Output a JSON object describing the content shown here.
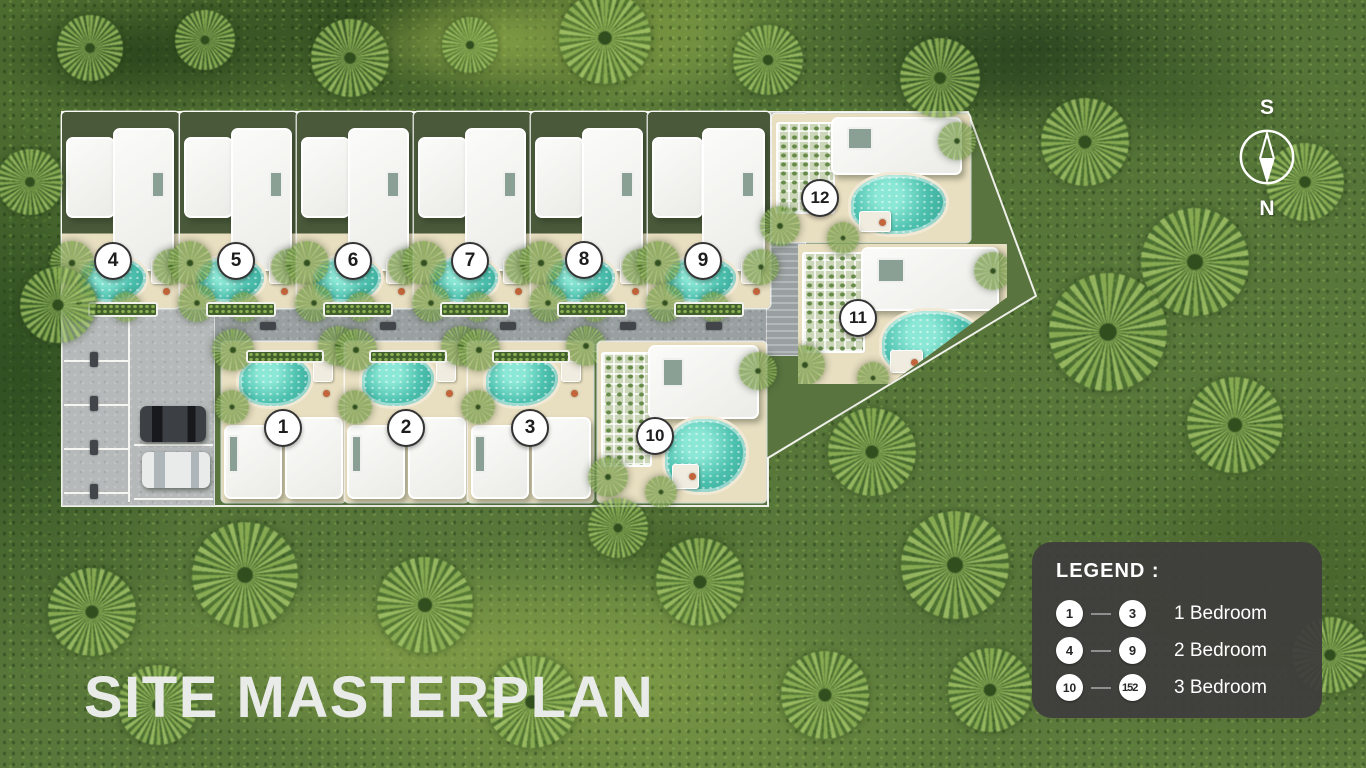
{
  "title": "SITE MASTERPLAN",
  "compass": {
    "top": "S",
    "bottom": "N"
  },
  "legend": {
    "heading": "LEGEND :",
    "rows": [
      {
        "from": "1",
        "to": "3",
        "label": "1 Bedroom"
      },
      {
        "from": "4",
        "to": "9",
        "label": "2 Bedroom"
      },
      {
        "from": "10",
        "to": "152",
        "label": "3 Bedroom"
      }
    ]
  },
  "units": [
    {
      "number": "1",
      "type": "bottom",
      "plot": {
        "x": 222,
        "y": 342,
        "w": 123,
        "h": 160
      },
      "badge": {
        "x": 283,
        "y": 428
      }
    },
    {
      "number": "2",
      "type": "bottom",
      "plot": {
        "x": 345,
        "y": 342,
        "w": 123,
        "h": 160
      },
      "badge": {
        "x": 406,
        "y": 428
      }
    },
    {
      "number": "3",
      "type": "bottom",
      "plot": {
        "x": 468,
        "y": 342,
        "w": 125,
        "h": 160
      },
      "badge": {
        "x": 530,
        "y": 428
      }
    },
    {
      "number": "4",
      "type": "top",
      "plot": {
        "x": 62,
        "y": 112,
        "w": 117,
        "h": 196
      },
      "badge": {
        "x": 113,
        "y": 261
      }
    },
    {
      "number": "5",
      "type": "top",
      "plot": {
        "x": 180,
        "y": 112,
        "w": 117,
        "h": 196
      },
      "badge": {
        "x": 236,
        "y": 261
      }
    },
    {
      "number": "6",
      "type": "top",
      "plot": {
        "x": 297,
        "y": 112,
        "w": 117,
        "h": 196
      },
      "badge": {
        "x": 353,
        "y": 261
      }
    },
    {
      "number": "7",
      "type": "top",
      "plot": {
        "x": 414,
        "y": 112,
        "w": 117,
        "h": 196
      },
      "badge": {
        "x": 470,
        "y": 261
      }
    },
    {
      "number": "8",
      "type": "top",
      "plot": {
        "x": 531,
        "y": 112,
        "w": 117,
        "h": 196
      },
      "badge": {
        "x": 584,
        "y": 260
      }
    },
    {
      "number": "9",
      "type": "top",
      "plot": {
        "x": 648,
        "y": 112,
        "w": 122,
        "h": 196
      },
      "badge": {
        "x": 703,
        "y": 261
      }
    },
    {
      "number": "10",
      "type": "side",
      "plot": {
        "x": 598,
        "y": 342,
        "w": 168,
        "h": 160
      },
      "badge": {
        "x": 655,
        "y": 436
      }
    },
    {
      "number": "11",
      "type": "side",
      "plot": {
        "x": 798,
        "y": 244,
        "w": 209,
        "h": 140
      },
      "badge": {
        "x": 858,
        "y": 318
      },
      "clipped": true
    },
    {
      "number": "12",
      "type": "side",
      "plot": {
        "x": 772,
        "y": 114,
        "w": 198,
        "h": 128
      },
      "badge": {
        "x": 820,
        "y": 198
      }
    }
  ],
  "colors": {
    "pool": "#49c0ae",
    "legend_bg": "#3e3c3c",
    "badge_border": "#333333",
    "title_text": "#e9ebe9"
  }
}
